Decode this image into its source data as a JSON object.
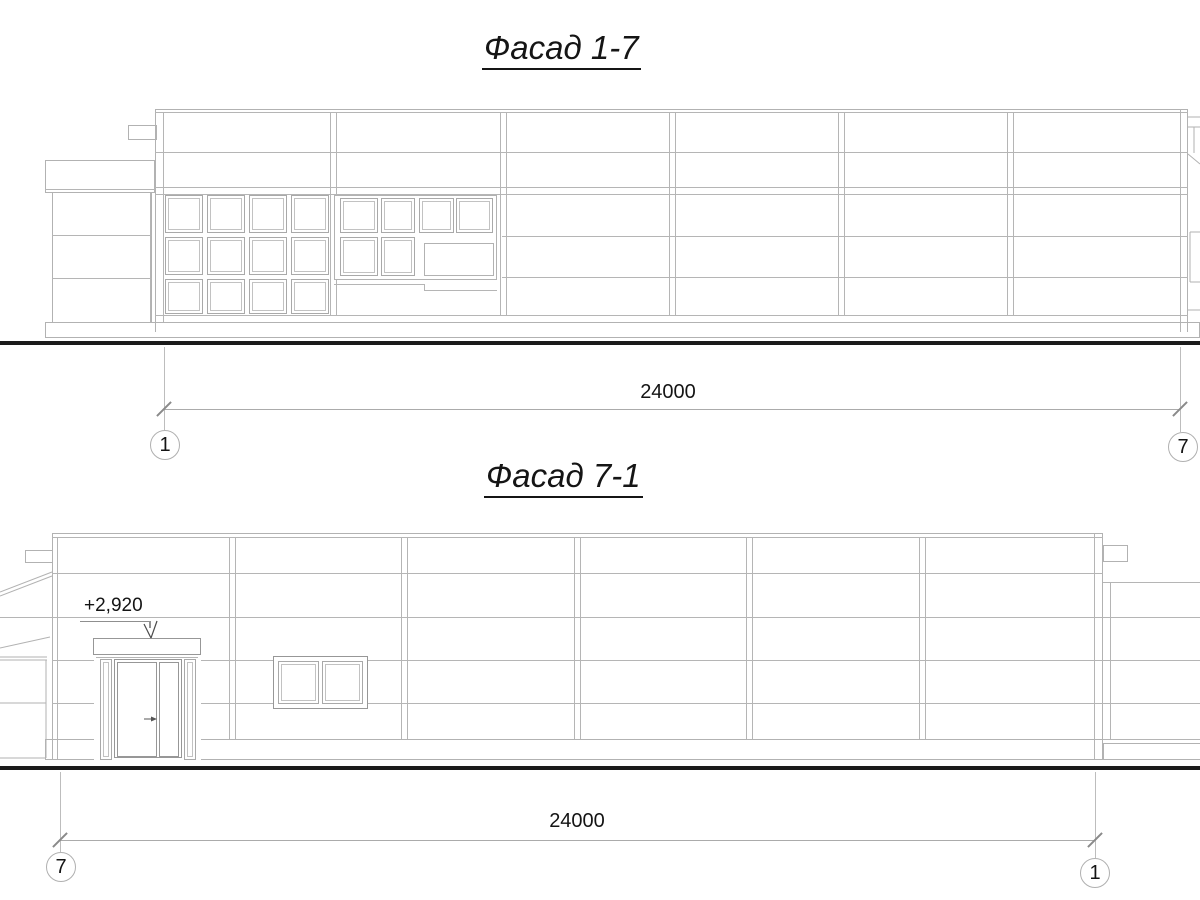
{
  "drawing": {
    "views": [
      {
        "id": "facade-1-7",
        "title": "Фасад 1-7",
        "overall_dimension": "24000",
        "axis_left": "1",
        "axis_right": "7"
      },
      {
        "id": "facade-7-1",
        "title": "Фасад 7-1",
        "overall_dimension": "24000",
        "axis_left": "7",
        "axis_right": "1",
        "canopy_elevation": "+2,920"
      }
    ],
    "colors": {
      "thin_line": "#b5b5b5",
      "frame_line": "#979797",
      "ground_line": "#1b1b1b",
      "text": "#141414"
    }
  }
}
